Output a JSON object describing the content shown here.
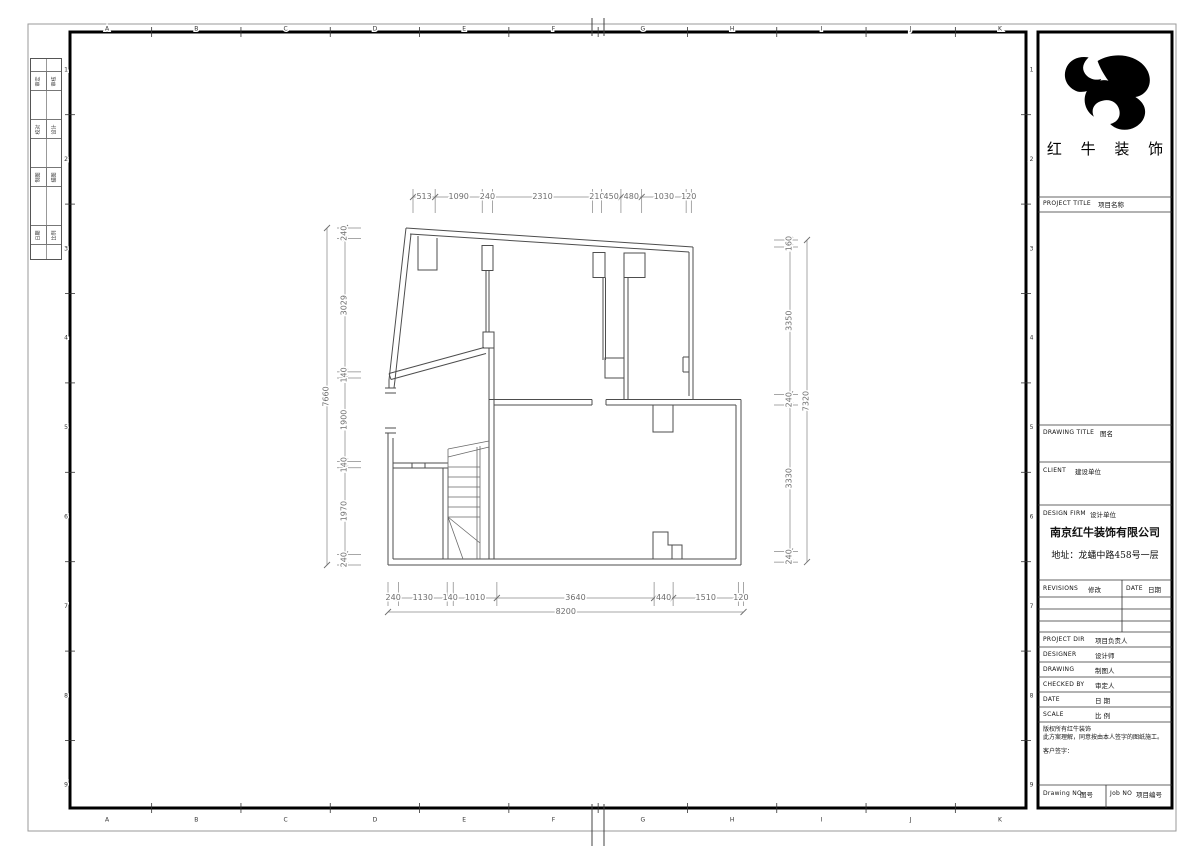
{
  "sheet": {
    "grid_letters": [
      "A",
      "B",
      "C",
      "D",
      "E",
      "F",
      "G",
      "H",
      "I",
      "J",
      "K"
    ],
    "grid_numbers": [
      "1",
      "2",
      "3",
      "4",
      "5",
      "6",
      "7",
      "8",
      "9"
    ]
  },
  "signature_strip": {
    "rows": [
      [
        "审定",
        "审核"
      ],
      [
        "校对",
        "设计"
      ],
      [
        "制图",
        "描图"
      ],
      [
        "日期",
        "比例"
      ]
    ]
  },
  "title_block": {
    "logo_text": "红 牛 装 饰",
    "project_title_en": "PROJECT TITLE",
    "project_title_zh": "项目名称",
    "drawing_title_en": "DRAWING TITLE",
    "drawing_title_zh": "图名",
    "client_en": "CLIENT",
    "client_zh": "建设单位",
    "design_firm_en": "DESIGN FIRM",
    "design_firm_zh": "设计单位",
    "company_name": "南京红牛装饰有限公司",
    "company_address": "地址：龙蟠中路458号一层",
    "revisions_en": "REVISIONS",
    "revisions_zh": "修改",
    "rev_date_en": "DATE",
    "rev_date_zh": "日期",
    "staff_rows": [
      {
        "en": "PROJECT DIR",
        "zh": "项目负责人"
      },
      {
        "en": "DESIGNER",
        "zh": "设计师"
      },
      {
        "en": "DRAWING",
        "zh": "制图人"
      },
      {
        "en": "CHECKED BY",
        "zh": "审定人"
      },
      {
        "en": "DATE",
        "zh": "日 期"
      },
      {
        "en": "SCALE",
        "zh": "比 例"
      }
    ],
    "copyright_line1": "版权所有红牛装饰",
    "copyright_line2": "此方案理解，同意按由本人签字的图纸施工。",
    "customer_sign": "客户签字：",
    "drawing_no_en": "Drawing NO",
    "drawing_no_zh": "图号",
    "job_no_en": "Job NO",
    "job_no_zh": "项目编号"
  },
  "dimensions": {
    "top": {
      "values": [
        513,
        1090,
        240,
        2310,
        210,
        450,
        480,
        1030,
        120
      ]
    },
    "bottom": {
      "values": [
        240,
        1130,
        140,
        1010,
        3640,
        440,
        1510,
        120
      ],
      "total": 8200
    },
    "left": {
      "values": [
        240,
        3029,
        140,
        1900,
        140,
        1970,
        240
      ],
      "total": 7660
    },
    "right": {
      "values": [
        160,
        3350,
        240,
        3330,
        240
      ],
      "total": 7320
    }
  }
}
